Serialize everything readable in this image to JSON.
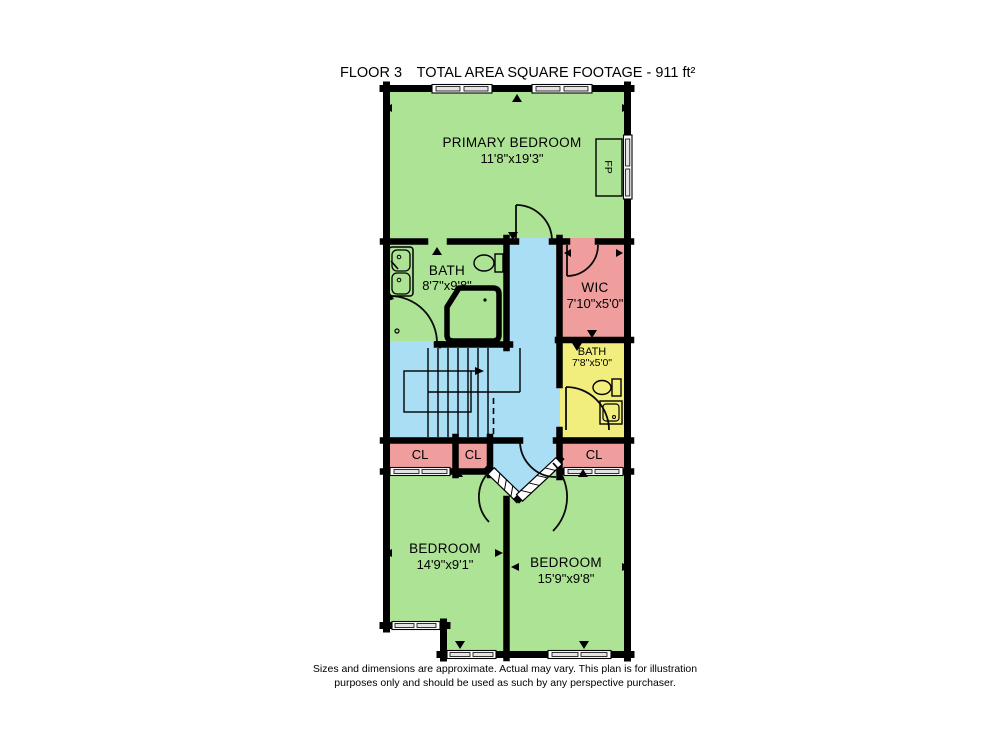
{
  "title": {
    "floor": "FLOOR 3",
    "area": "TOTAL AREA SQUARE FOOTAGE - 911 ft²"
  },
  "rooms": {
    "primary_bedroom": {
      "name": "PRIMARY BEDROOM",
      "dims": "11'8\"x19'3\""
    },
    "bath_main": {
      "name": "BATH",
      "dims": "8'7\"x9'8\""
    },
    "wic": {
      "name": "WIC",
      "dims": "7'10\"x5'0\""
    },
    "bath_small": {
      "name": "BATH",
      "dims": "7'8\"x5'0\""
    },
    "closet_left": {
      "label": "CL"
    },
    "closet_mid": {
      "label": "CL"
    },
    "closet_right": {
      "label": "CL"
    },
    "bedroom_left": {
      "name": "BEDROOM",
      "dims": "14'9\"x9'1\""
    },
    "bedroom_right": {
      "name": "BEDROOM",
      "dims": "15'9\"x9'8\""
    },
    "fireplace": {
      "label": "FP"
    }
  },
  "footer": {
    "line1": "Sizes and dimensions are approximate. Actual may vary. This plan is for illustration",
    "line2": "purposes only and should be used as such by any perspective purchaser."
  },
  "colors": {
    "room_green": "#ade394",
    "hall_blue": "#a9def5",
    "closet_pink": "#ef9d9d",
    "bath_yellow": "#f2ee7d",
    "wall": "#000000",
    "window_pane": "#e4e4e4"
  }
}
